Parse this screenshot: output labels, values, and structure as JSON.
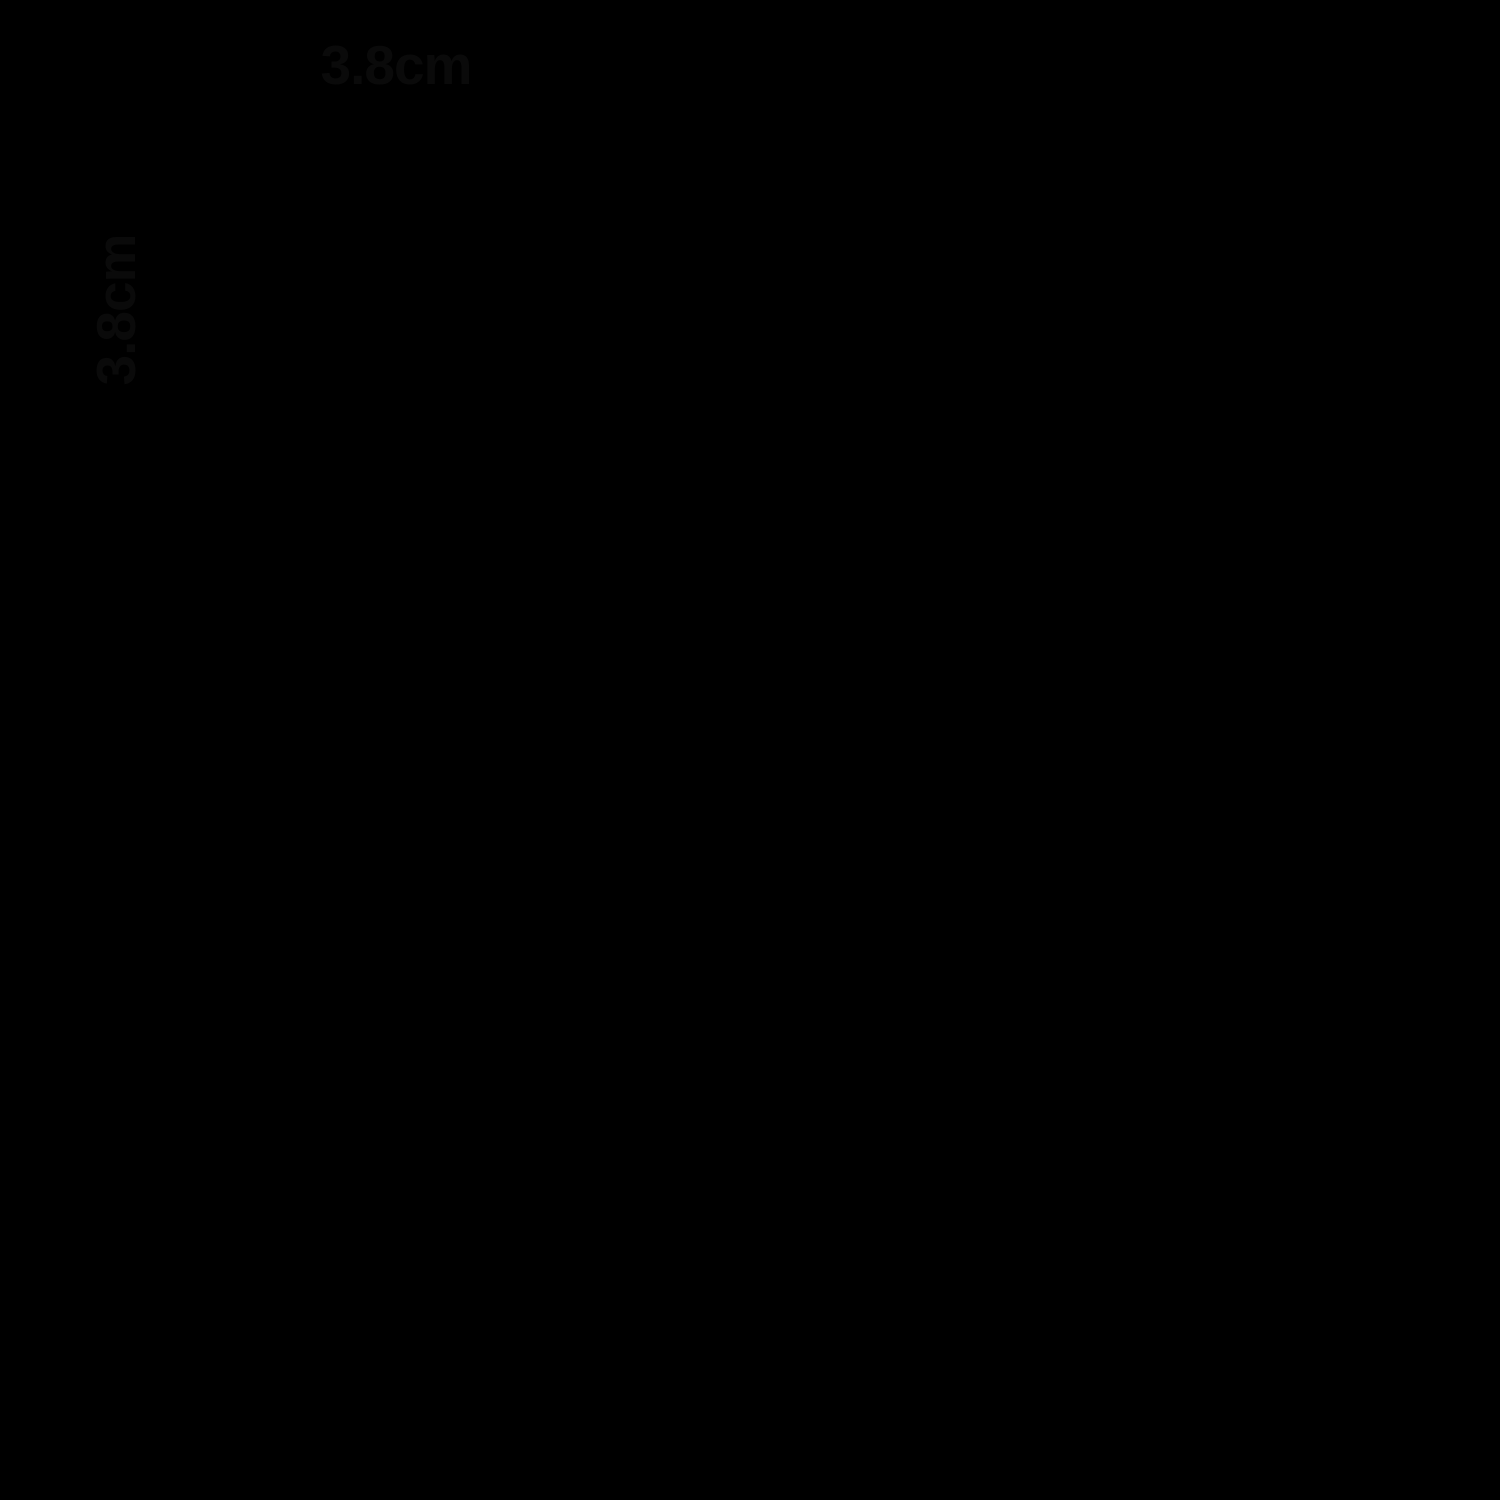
{
  "figure": {
    "background": "#fcfcfa",
    "mesh": {
      "wire_color": "#b7c5d6",
      "wire_color_alt": "#a8b8cb",
      "wire_edge_color": "#8095ab",
      "wire_highlight": "#edf2f7",
      "wire_shade": "#8da2b6",
      "crimp_color": "#5c7086",
      "halo_color": "#a89e8d",
      "wire_thickness_px": 18,
      "vertical_wires": [
        {
          "x_top": 277,
          "x_bottom": 282,
          "y_top": 137
        },
        {
          "x_top": 513,
          "x_bottom": 521,
          "y_top": 137
        },
        {
          "x_top": 750,
          "x_bottom": 757,
          "y_top": 136
        },
        {
          "x_top": 990,
          "x_bottom": 995,
          "y_top": 136
        },
        {
          "x_top": 1230,
          "x_bottom": 1236,
          "y_top": 135
        },
        {
          "x_top": 1472,
          "x_bottom": 1458,
          "y_top": 128
        }
      ],
      "horizontal_wires": [
        {
          "y_left": 186,
          "y_right": 179,
          "x_left": 213
        },
        {
          "y_left": 464,
          "y_right": 455,
          "x_left": 210
        },
        {
          "y_left": 740,
          "y_right": 736,
          "x_left": 219
        },
        {
          "y_left": 1016,
          "y_right": 1010,
          "x_left": 218
        },
        {
          "y_left": 1290,
          "y_right": 1284,
          "x_left": 228
        }
      ]
    },
    "specks": [
      [
        435,
        227
      ],
      [
        1113,
        417
      ],
      [
        830,
        541
      ],
      [
        1275,
        688
      ],
      [
        373,
        864
      ],
      [
        237,
        1128
      ],
      [
        680,
        1424
      ],
      [
        960,
        1246
      ],
      [
        1415,
        1190
      ],
      [
        712,
        311
      ]
    ],
    "artifact_line": {
      "d": "M1478,128 Q1487,560 1501,1005",
      "color": "#161616",
      "width": 3.5
    }
  },
  "annotations": {
    "color": "#000000",
    "stroke_width": 5,
    "top_dimension": {
      "label": "3.8cm",
      "ticks_x": [
        277,
        514
      ],
      "tick_y1": 50,
      "tick_y2": 137,
      "line_y": 92,
      "line_x1": 283,
      "line_x2": 509
    },
    "left_dimension": {
      "label": "3.8cm",
      "ticks_y": [
        185,
        463
      ],
      "tick_x1": 112,
      "tick_x2": 214,
      "line_x": 152,
      "line_y1": 187,
      "line_y2": 461
    }
  }
}
